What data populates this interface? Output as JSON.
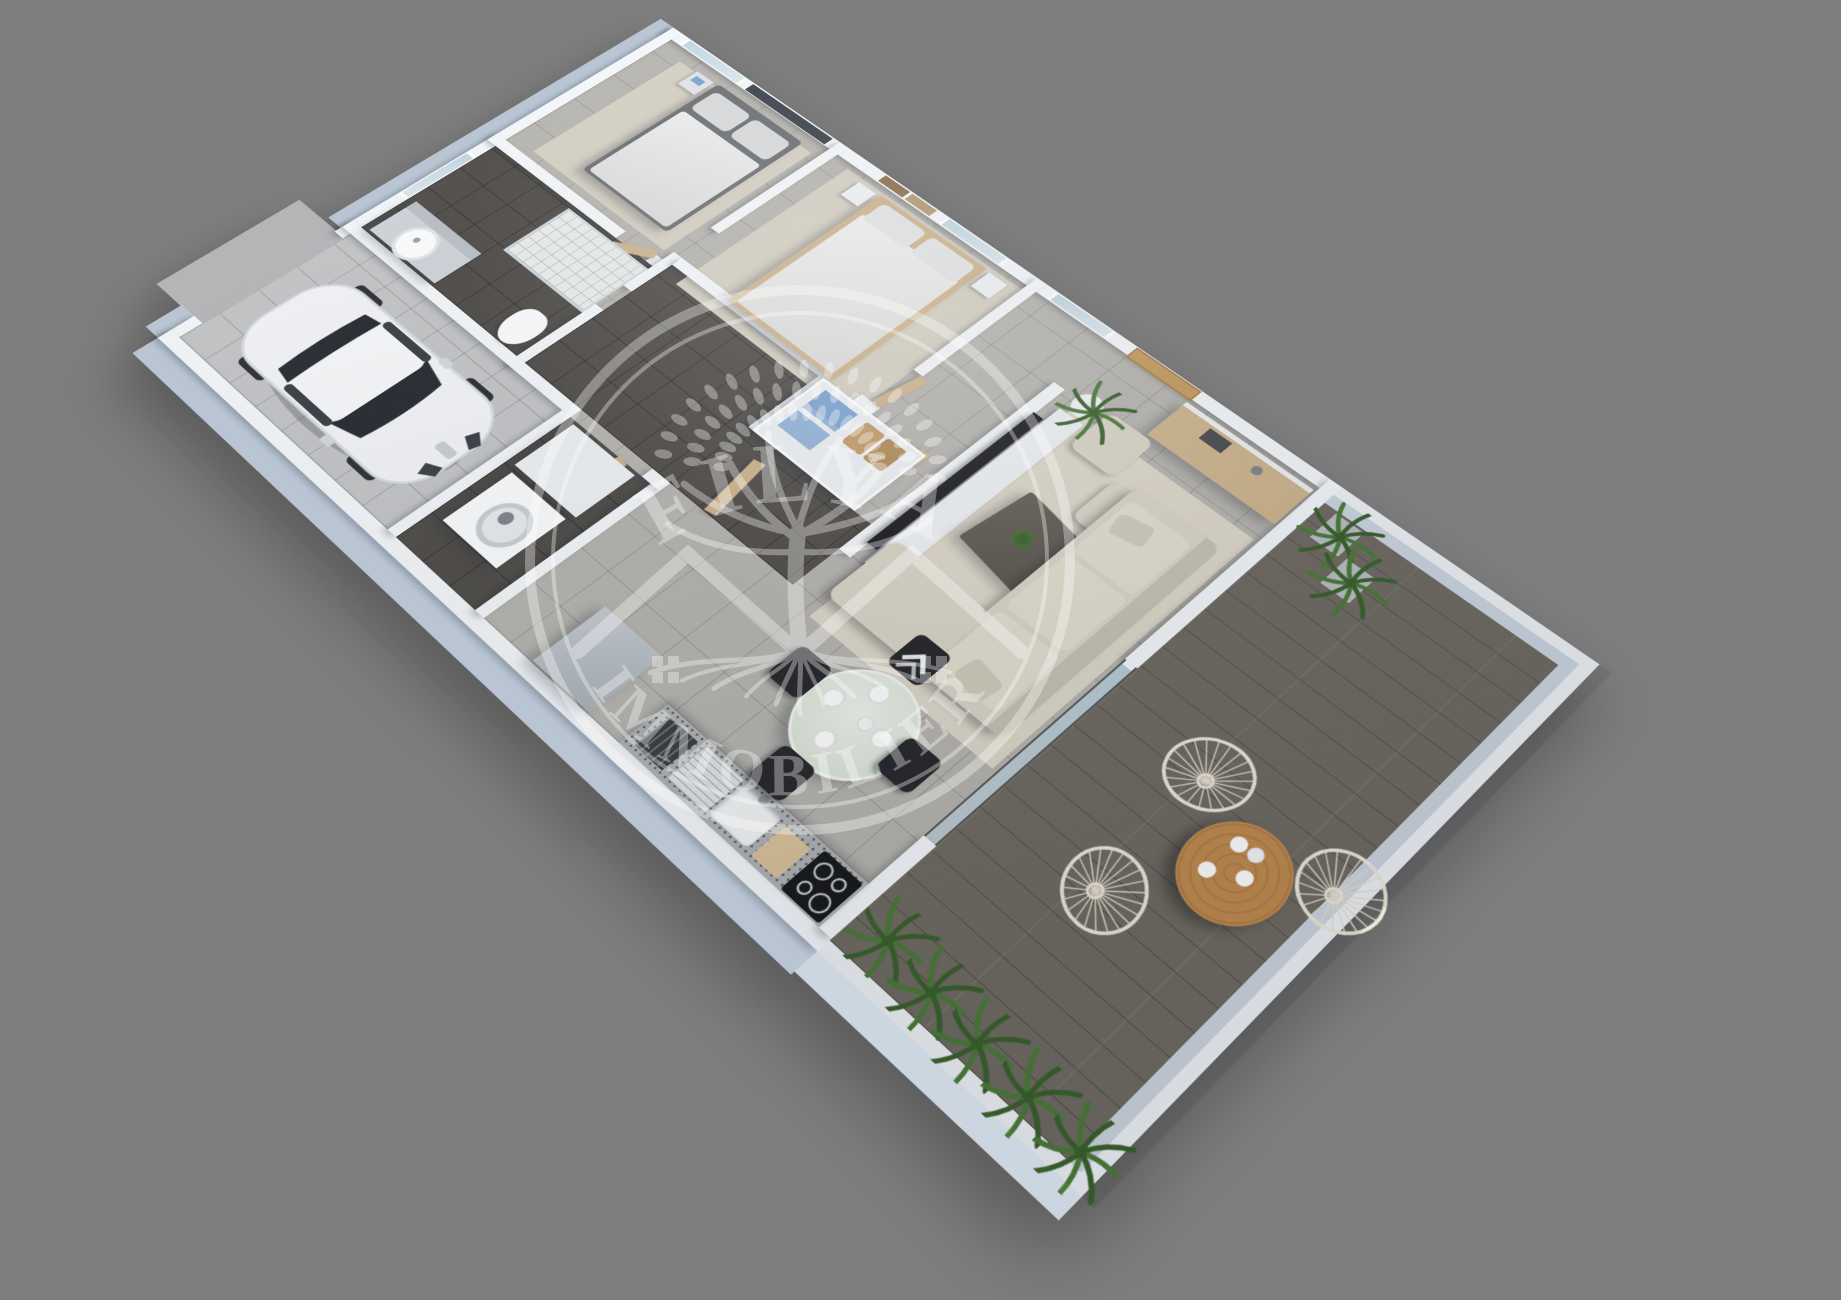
{
  "watermark": {
    "top_text": "FILYA",
    "bottom_text": "IMMOBILIER",
    "opacity": 0.34,
    "color": "#ffffff",
    "elements": [
      "outer-ring",
      "inner-ring",
      "tree-with-leaves",
      "tree-roots",
      "house-roof-left",
      "house-roof-right",
      "window-grid-left",
      "window-grid-right"
    ]
  },
  "palette": {
    "bg": "#7e7e7e",
    "wall": "#f4f7fa",
    "wallFace": "#b9c5d3",
    "wallLow": "#eef2f6",
    "wallLowFace": "#ccd6e0",
    "floorLight": "#b6b4af",
    "floorLine": "#a19f99",
    "floorDark": "#4e4b47",
    "floorDarkLine": "#403d39",
    "floorGarage": "#c3c4c6",
    "apron": "#b4b5b7",
    "terraceWood": "#6f6a62",
    "terraceLine": "#5e594f",
    "rug": "#ddd7c9",
    "rugBed": "#d4cfc2",
    "sofa": "#d9d4c6",
    "sofaEdge": "#c6c1b2",
    "woodLight": "#cdb48d",
    "woodMid": "#c49a5f",
    "glass": "#bcd3de",
    "glassTable": "#dde6da",
    "chairBlack": "#26272b",
    "towelBlue": "#7ba3d2",
    "towelBlue2": "#92b3da",
    "basket": "#c29b66",
    "plantGreen": "#4a7a38",
    "plantDark": "#39602c",
    "granite": "#aeb2b4",
    "appliance": "#eef1f4",
    "tvBlack": "#17181c",
    "accentWall": "#3a4049",
    "artWood": "#8a6f4e",
    "artWood2": "#b59a73",
    "carBody": "#f3f4f7",
    "carGlass": "#26292f",
    "potGray": "#b9bec3",
    "tableWoodTop": "#c08b50",
    "coffeeTable": "#56524a",
    "watermark": "#ffffff"
  },
  "scene": {
    "type": "3d-floor-plan-render",
    "view": "isometric-top-down",
    "rooms": [
      {
        "name": "garage",
        "furniture": [
          "white-car",
          "driveway-apron"
        ]
      },
      {
        "name": "laundry",
        "furniture": [
          "washing-machine",
          "storage-cabinet"
        ]
      },
      {
        "name": "bathroom",
        "furniture": [
          "vanity-round-sink",
          "shower",
          "toilet",
          "window"
        ]
      },
      {
        "name": "bedroom-1",
        "furniture": [
          "double-bed",
          "nightstand",
          "dark-accent-wall",
          "rug",
          "windows"
        ]
      },
      {
        "name": "bedroom-2",
        "furniture": [
          "double-bed",
          "nightstands",
          "wall-art-panels",
          "rug",
          "window"
        ]
      },
      {
        "name": "hallway",
        "furniture": [
          "wooden-doors",
          "dark-tile-floor"
        ]
      },
      {
        "name": "dressing",
        "furniture": [
          "open-closet",
          "blue-towels",
          "wicker-baskets"
        ]
      },
      {
        "name": "entry",
        "furniture": [
          "wooden-front-door",
          "sideboard",
          "books",
          "lamp",
          "potted-plant",
          "window"
        ]
      },
      {
        "name": "living-room",
        "furniture": [
          "l-shaped-sofa",
          "coffee-table-with-plant",
          "tv-panel",
          "tv-bench",
          "poufs",
          "rug",
          "sliding-glass-door"
        ]
      },
      {
        "name": "kitchen-dining",
        "furniture": [
          "fridge",
          "granite-counter",
          "sink-with-drainboard",
          "cooktop",
          "dish-rack",
          "round-glass-table",
          "four-black-chairs",
          "tableware"
        ]
      },
      {
        "name": "terrace",
        "furniture": [
          "round-wood-table",
          "wire-chairs",
          "potted-palms",
          "palm-shrub-row",
          "low-walls",
          "wood-deck"
        ]
      }
    ]
  }
}
